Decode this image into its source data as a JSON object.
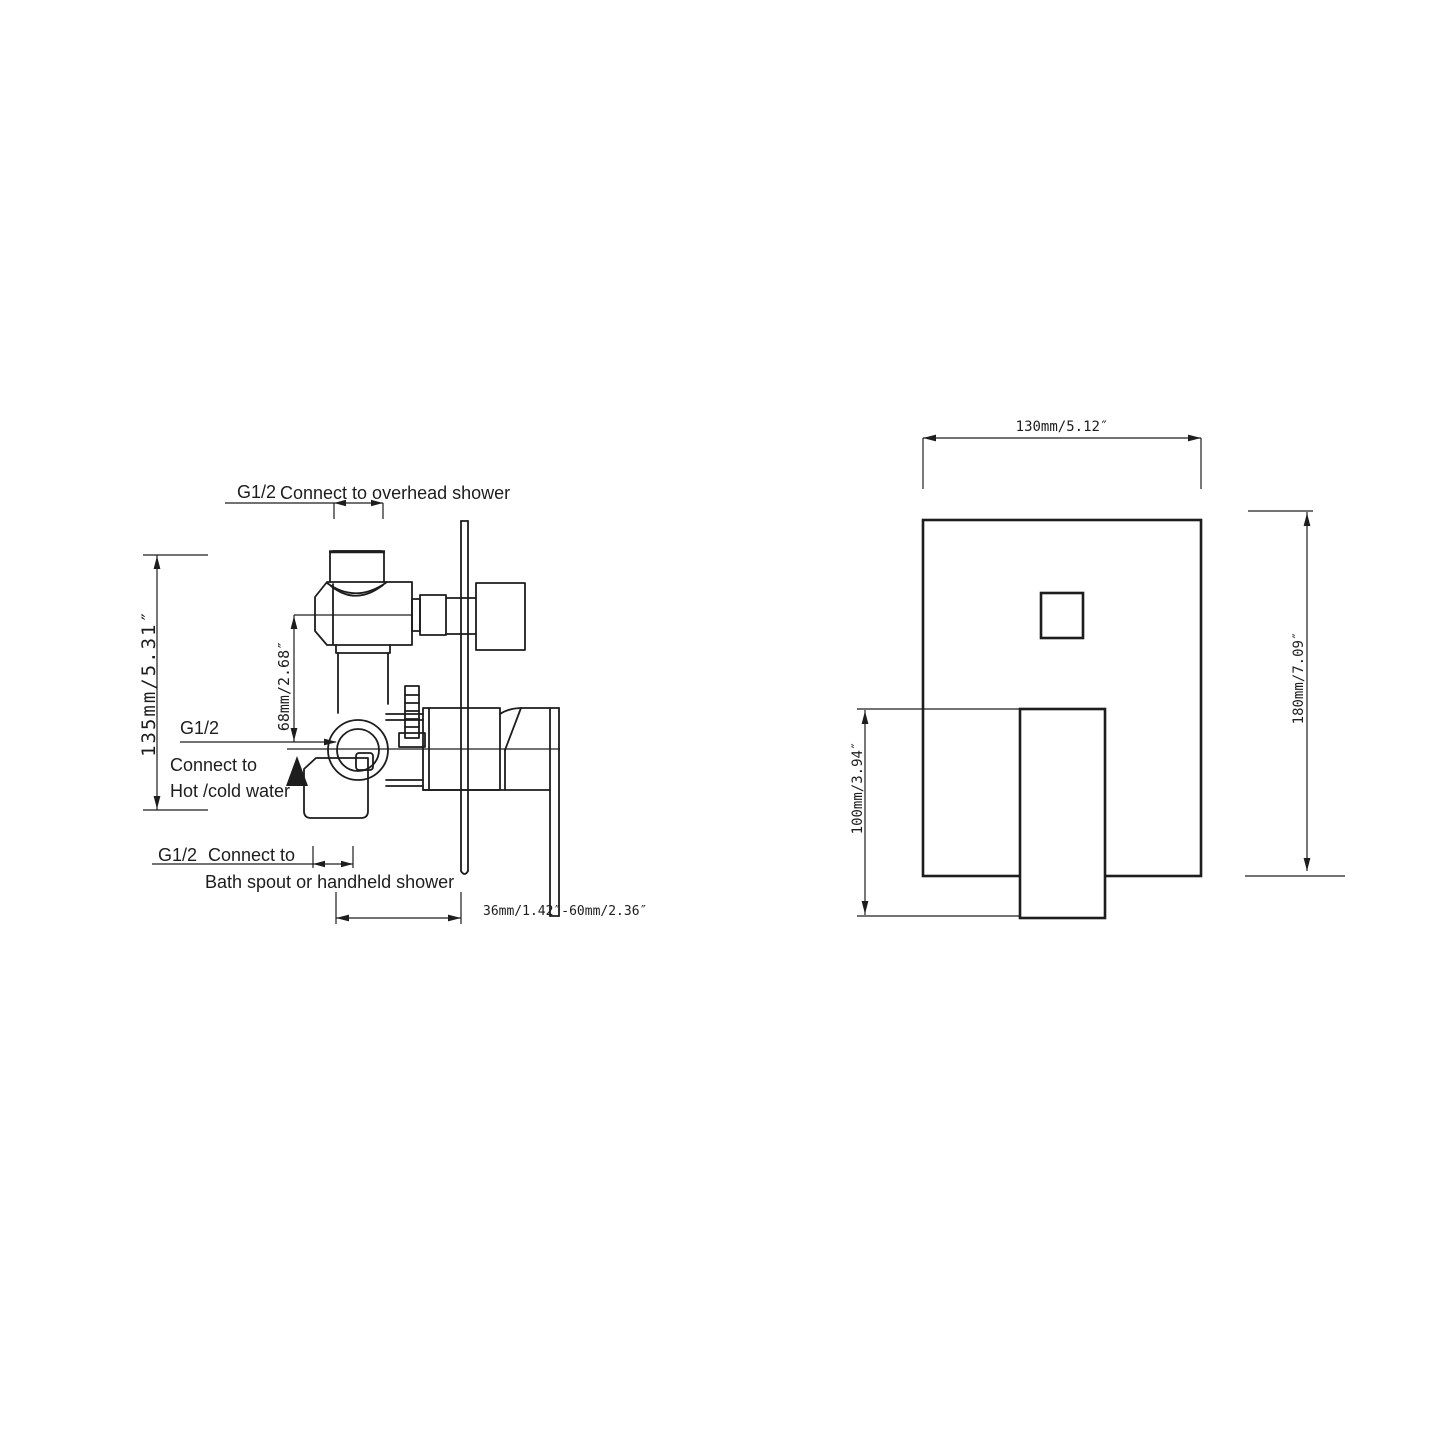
{
  "drawing": {
    "colors": {
      "background": "#ffffff",
      "line": "#1d1d1d"
    },
    "side_view": {
      "top_label": {
        "thread": "G1/2",
        "text": "Connect to overhead shower"
      },
      "inlet_label": {
        "thread": "G1/2",
        "line1": "Connect to",
        "line2": "Hot /cold water"
      },
      "bottom_label": {
        "thread": "G1/2",
        "line1": "Connect to",
        "line2": "Bath spout or handheld shower"
      },
      "dims": {
        "height": "135mm/5.31″",
        "port_offset": "68mm/2.68″",
        "depth_range": "36mm/1.42″-60mm/2.36″"
      }
    },
    "front_view": {
      "dims": {
        "width": "130mm/5.12″",
        "height": "180mm/7.09″",
        "handle_height": "100mm/3.94″"
      }
    }
  }
}
